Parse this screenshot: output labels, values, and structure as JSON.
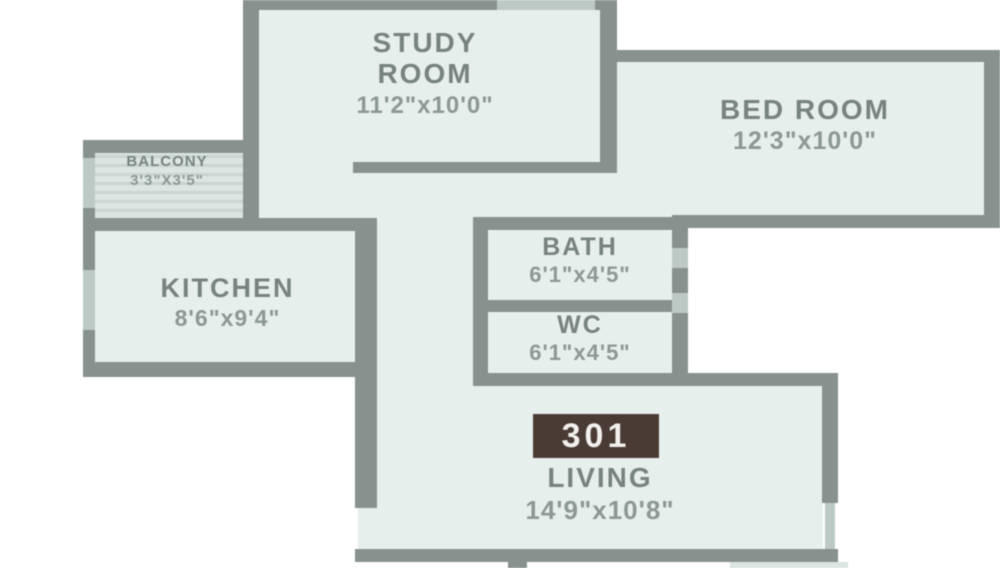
{
  "plan": {
    "unit_number": "301",
    "rooms": [
      {
        "id": "study",
        "name_lines": [
          "STUDY",
          "ROOM"
        ],
        "dims": "11'2\"x10'0\""
      },
      {
        "id": "bedroom",
        "name_lines": [
          "BED ROOM"
        ],
        "dims": "12'3\"x10'0\""
      },
      {
        "id": "balcony",
        "name_lines": [
          "BALCONY"
        ],
        "dims": "3'3\"X3'5\""
      },
      {
        "id": "kitchen",
        "name_lines": [
          "KITCHEN"
        ],
        "dims": "8'6\"x9'4\""
      },
      {
        "id": "bath",
        "name_lines": [
          "BATH"
        ],
        "dims": "6'1\"x4'5\""
      },
      {
        "id": "wc",
        "name_lines": [
          "WC"
        ],
        "dims": "6'1\"x4'5\""
      },
      {
        "id": "living",
        "name_lines": [
          "LIVING"
        ],
        "dims": "14'9\"x10'8\""
      }
    ],
    "colors": {
      "wall": "#87928e",
      "room_fill": "#e7efec",
      "balcony_fill": "#dbe5e1",
      "balcony_hatch": "#c8d5d0",
      "window_color": "#bdc9c4",
      "label_text": "#76837f",
      "dim_text": "#8b9894",
      "badge_bg": "#4a3c35",
      "badge_text": "#f2efec"
    }
  }
}
